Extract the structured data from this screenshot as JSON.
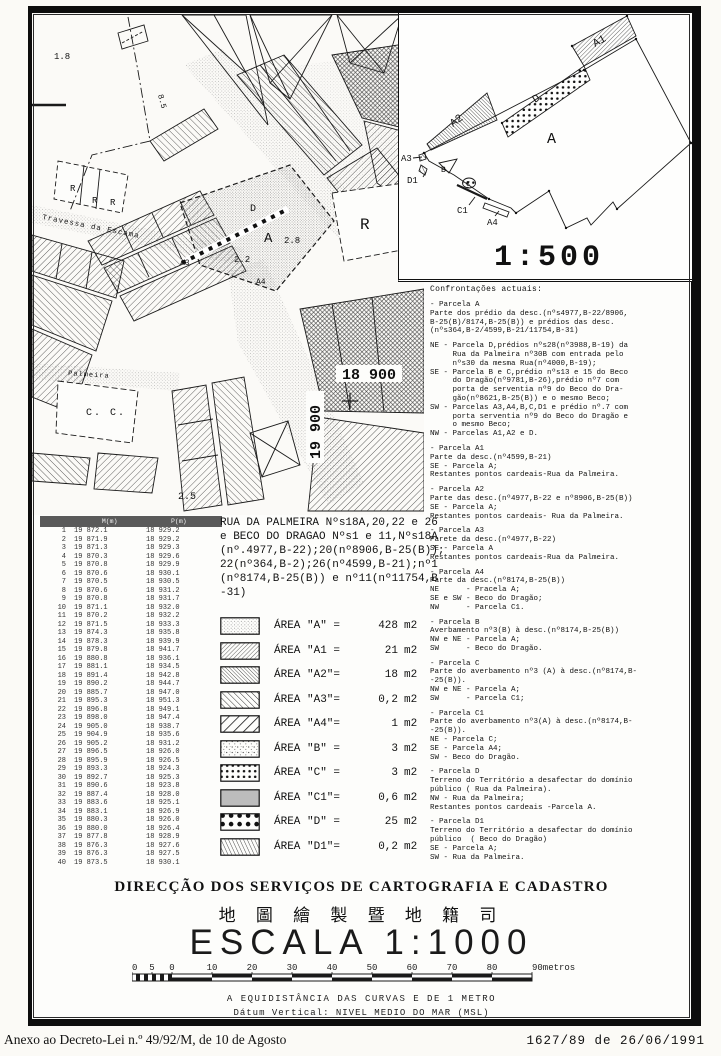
{
  "document": {
    "annex_note": "Anexo ao Decreto-Lei n.º 49/92/M, de 10 de Agosto",
    "process_ref": "1627/89 de 26/06/1991"
  },
  "inset": {
    "scale": "1:500",
    "labels": {
      "a": "A",
      "a1": "A1",
      "a2": "A2",
      "a3": "A3",
      "a4": "A4",
      "b": "B",
      "c": "C",
      "c1": "C1",
      "d": "D",
      "d1": "D1"
    }
  },
  "map": {
    "grid_label_h": "18 900",
    "grid_label_v": "19 900",
    "street_travessa": "Travessa da Escama",
    "street_palmeira": "Palmeira",
    "label_cc": "C. C.",
    "r": "R",
    "spot_18": "1.8",
    "spot_85": "8.5",
    "spot_25": "2.5",
    "spot_22": "2.2",
    "spot_28": "2.8",
    "parcel_a": "A",
    "parcel_d": "D",
    "parcel_a3": "A3",
    "parcel_a4": "A4"
  },
  "coordinates_table": {
    "col_m": "M(m)",
    "col_p": "P(m)",
    "rows": [
      [
        "1",
        "19 872.1",
        "18 929.2"
      ],
      [
        "2",
        "19 871.9",
        "18 929.2"
      ],
      [
        "3",
        "19 871.3",
        "18 929.3"
      ],
      [
        "4",
        "19 870.3",
        "18 929.6"
      ],
      [
        "5",
        "19 870.8",
        "18 929.9"
      ],
      [
        "6",
        "19 870.6",
        "18 930.1"
      ],
      [
        "7",
        "19 870.5",
        "18 930.5"
      ],
      [
        "8",
        "19 870.6",
        "18 931.2"
      ],
      [
        "9",
        "19 870.8",
        "18 931.7"
      ],
      [
        "10",
        "19 871.1",
        "18 932.0"
      ],
      [
        "11",
        "19 870.2",
        "18 932.2"
      ],
      [
        "12",
        "19 871.5",
        "18 933.3"
      ],
      [
        "13",
        "19 874.3",
        "18 935.8"
      ],
      [
        "14",
        "19 878.3",
        "18 939.9"
      ],
      [
        "15",
        "19 879.8",
        "18 941.7"
      ],
      [
        "16",
        "19 880.8",
        "18 936.1"
      ],
      [
        "17",
        "19 881.1",
        "18 934.5"
      ],
      [
        "18",
        "19 891.4",
        "18 942.8"
      ],
      [
        "19",
        "19 890.2",
        "18 944.7"
      ],
      [
        "20",
        "19 885.7",
        "18 947.0"
      ],
      [
        "21",
        "19 895.3",
        "18 951.3"
      ],
      [
        "22",
        "19 896.8",
        "18 949.1"
      ],
      [
        "23",
        "19 898.0",
        "18 947.4"
      ],
      [
        "24",
        "19 905.0",
        "18 938.7"
      ],
      [
        "25",
        "19 904.9",
        "18 935.6"
      ],
      [
        "26",
        "19 905.2",
        "18 931.2"
      ],
      [
        "27",
        "19 896.5",
        "18 926.0"
      ],
      [
        "28",
        "19 895.9",
        "18 926.5"
      ],
      [
        "29",
        "19 893.3",
        "18 924.3"
      ],
      [
        "30",
        "19 892.7",
        "18 925.3"
      ],
      [
        "31",
        "19 890.6",
        "18 923.8"
      ],
      [
        "32",
        "19 887.4",
        "18 928.0"
      ],
      [
        "33",
        "19 883.6",
        "18 925.1"
      ],
      [
        "34",
        "19 883.1",
        "18 926.9"
      ],
      [
        "35",
        "19 880.3",
        "18 926.0"
      ],
      [
        "36",
        "19 880.0",
        "18 926.4"
      ],
      [
        "37",
        "19 877.8",
        "18 928.9"
      ],
      [
        "38",
        "19 876.3",
        "18 927.6"
      ],
      [
        "39",
        "19 876.3",
        "18 927.5"
      ],
      [
        "40",
        "19 873.5",
        "18 930.1"
      ]
    ]
  },
  "title_block": {
    "text": "RUA DA PALMEIRA Nºs18A,20,22 e 26\ne BECO DO DRAGAO Nºs1 e 11,Nºs18A\n(nº.4977,B-22);20(nº8906,B-25(B));\n22(nº364,B-2);26(nº4599,B-21);nº1\n(nº8174,B-25(B)) e nº11(nº11754,B\n-31)"
  },
  "legend": {
    "items": [
      {
        "key": "a",
        "label": "ÁREA \"A\" =",
        "value": "428",
        "unit": "m2",
        "pattern": "p-leg-a"
      },
      {
        "key": "a1",
        "label": "ÁREA \"A1 =",
        "value": "21",
        "unit": "m2",
        "pattern": "p-leg-a1"
      },
      {
        "key": "a2",
        "label": "ÁREA \"A2\"=",
        "value": "18",
        "unit": "m2",
        "pattern": "p-leg-a2"
      },
      {
        "key": "a3",
        "label": "ÁREA \"A3\"=",
        "value": "0,2",
        "unit": "m2",
        "pattern": "p-leg-a3"
      },
      {
        "key": "a4",
        "label": "ÁREA \"A4\"=",
        "value": "1",
        "unit": "m2",
        "pattern": "p-leg-a4"
      },
      {
        "key": "b",
        "label": "ÁREA \"B\" =",
        "value": "3",
        "unit": "m2",
        "pattern": "p-leg-b"
      },
      {
        "key": "c",
        "label": "ÁREA \"C\" =",
        "value": "3",
        "unit": "m2",
        "pattern": "p-leg-c"
      },
      {
        "key": "c1",
        "label": "ÁREA \"C1\"=",
        "value": "0,6",
        "unit": "m2",
        "pattern": "#bcbcbc"
      },
      {
        "key": "d",
        "label": "ÁREA \"D\" =",
        "value": "25",
        "unit": "m2",
        "pattern": "p-leg-d"
      },
      {
        "key": "d1",
        "label": "ÁREA \"D1\"=",
        "value": "0,2",
        "unit": "m2",
        "pattern": "p-leg-d1"
      }
    ]
  },
  "confrontacoes": {
    "title": "Confrontações actuais:",
    "blocks": [
      "- Parcela A\nParte dos prédio da desc.(nºs4977,B-22/8906,\nB-25(B)/8174,B-25(B)) e prédios das desc.\n(nºs364,B-2/4599,B-21/11754,B-31)",
      "NE - Parcela D,prédios nºs28(nº3988,B-19) da\n     Rua da Palmeira nº30B com entrada pelo\n     nºs30 da mesma Rua(nº4000,B-19);\nSE - Parcela B e C,prédio nºs13 e 15 do Beco\n     do Dragão(nº9781,B-26),prédio nº7 com\n     porta de serventia nº9 do Beco do Dra-\n     gão(nº8621,B-25(B)) e o mesmo Beco;\nSW - Parcelas A3,A4,B,C,D1 e prédio nº.7 com\n     porta serventia nº9 do Beco do Dragão e\n     o mesmo Beco;\nNW - Parcelas A1,A2 e D.",
      "- Parcela A1\nParte da desc.(nº4599,B-21)\nSE - Parcela A;\nRestantes pontos cardeais-Rua da Palmeira.",
      "- Parcela A2\nParte das desc.(nº4977,B-22 e nº8906,B-25(B))\nSE - Parcela A;\nRestantes pontos cardeais- Rua da Palmeira.",
      "- Parcela A3\nParete da desc.(nº4977,B-22)\nSE - Parcela A\nRestantes pontos cardeais-Rua da Palmeira.",
      "- Parcela A4\nParte da desc.(nº8174,B-25(B))\nNE      - Pracela A;\nSE e SW - Beco do Dragão;\nNW      - Parcela C1.",
      "- Parcela B\nAverbamento nº3(B) à desc.(nº8174,B-25(B))\nNW e NE - Parcela A;\nSW      - Beco do Dragão.",
      "- Parcela C\nParte do averbamento nº3 (A) à desc.(nº8174,B-\n-25(B)).\nNW e NE - Parcela A;\nSW      - Parcela C1;",
      "- Parcela C1\nParte do averbamento nº3(A) à desc.(nº8174,B-\n-25(B)).\nNE - Parcela C;\nSE - Parcela A4;\nSW - Beco do Dragão.",
      "- Parcela D\nTerreno do Território a desafectar do domínio\npúblico ( Rua da Palmeira).\nNW - Rua da Palmeira;\nRestantes pontos cardeais -Parcela A.",
      "- Parcela D1\nTerreno do Território a desafectar do domínio\npúblico  ( Beco do Dragão)\nSE - Parcela A;\nSW - Rua da Palmeira."
    ]
  },
  "footer": {
    "org_pt": "DIRECÇÃO DOS SERVIÇOS DE CARTOGRAFIA E CADASTRO",
    "org_zh": "地 圖 繪 製 暨 地 籍 司",
    "scale_label": "ESCALA 1:1000",
    "scalebar": {
      "labels": [
        "10",
        "5",
        "0",
        "10",
        "20",
        "30",
        "40",
        "50",
        "60",
        "70",
        "80",
        "90metros"
      ]
    },
    "equidistance": "A EQUIDISTÂNCIA DAS CURVAS E DE 1 METRO",
    "datum": "Dátum Vertical: NIVEL MEDIO DO MAR (MSL)"
  }
}
